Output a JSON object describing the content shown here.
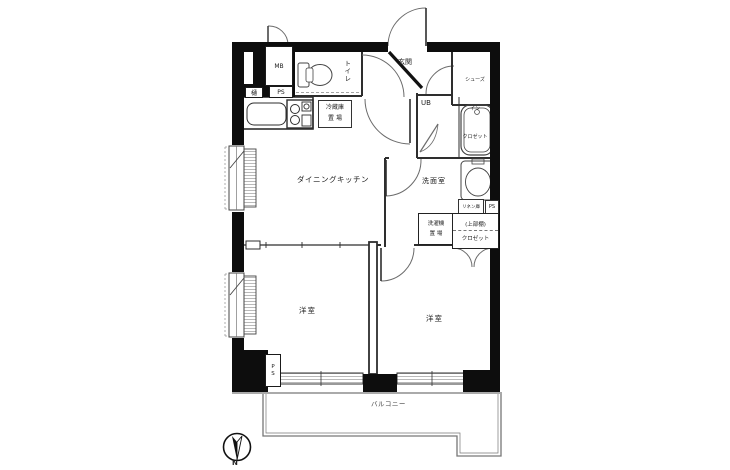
{
  "plan": {
    "meter_box": "MB",
    "gutter": "樋",
    "ps_top": "PS",
    "toilet": "トイレ",
    "entrance": "玄関",
    "shoes_closet": [
      "シューズ",
      "イン",
      "クロゼット"
    ],
    "unit_bath": "UB",
    "refrigerator": [
      "冷蔵庫",
      "置 場"
    ],
    "dining_kitchen": "ダイニングキッチン",
    "washroom": "洗面室",
    "linen": "リネン庫",
    "ps_mid": "PS",
    "washer": [
      "洗濯機",
      "置 場"
    ],
    "closet_upper": "(上部棚)",
    "closet": "クロゼット",
    "western_room_1": "洋室",
    "western_room_2": "洋室",
    "ps_bottom": "PS",
    "balcony": "バルコニー",
    "compass_north": "N"
  }
}
